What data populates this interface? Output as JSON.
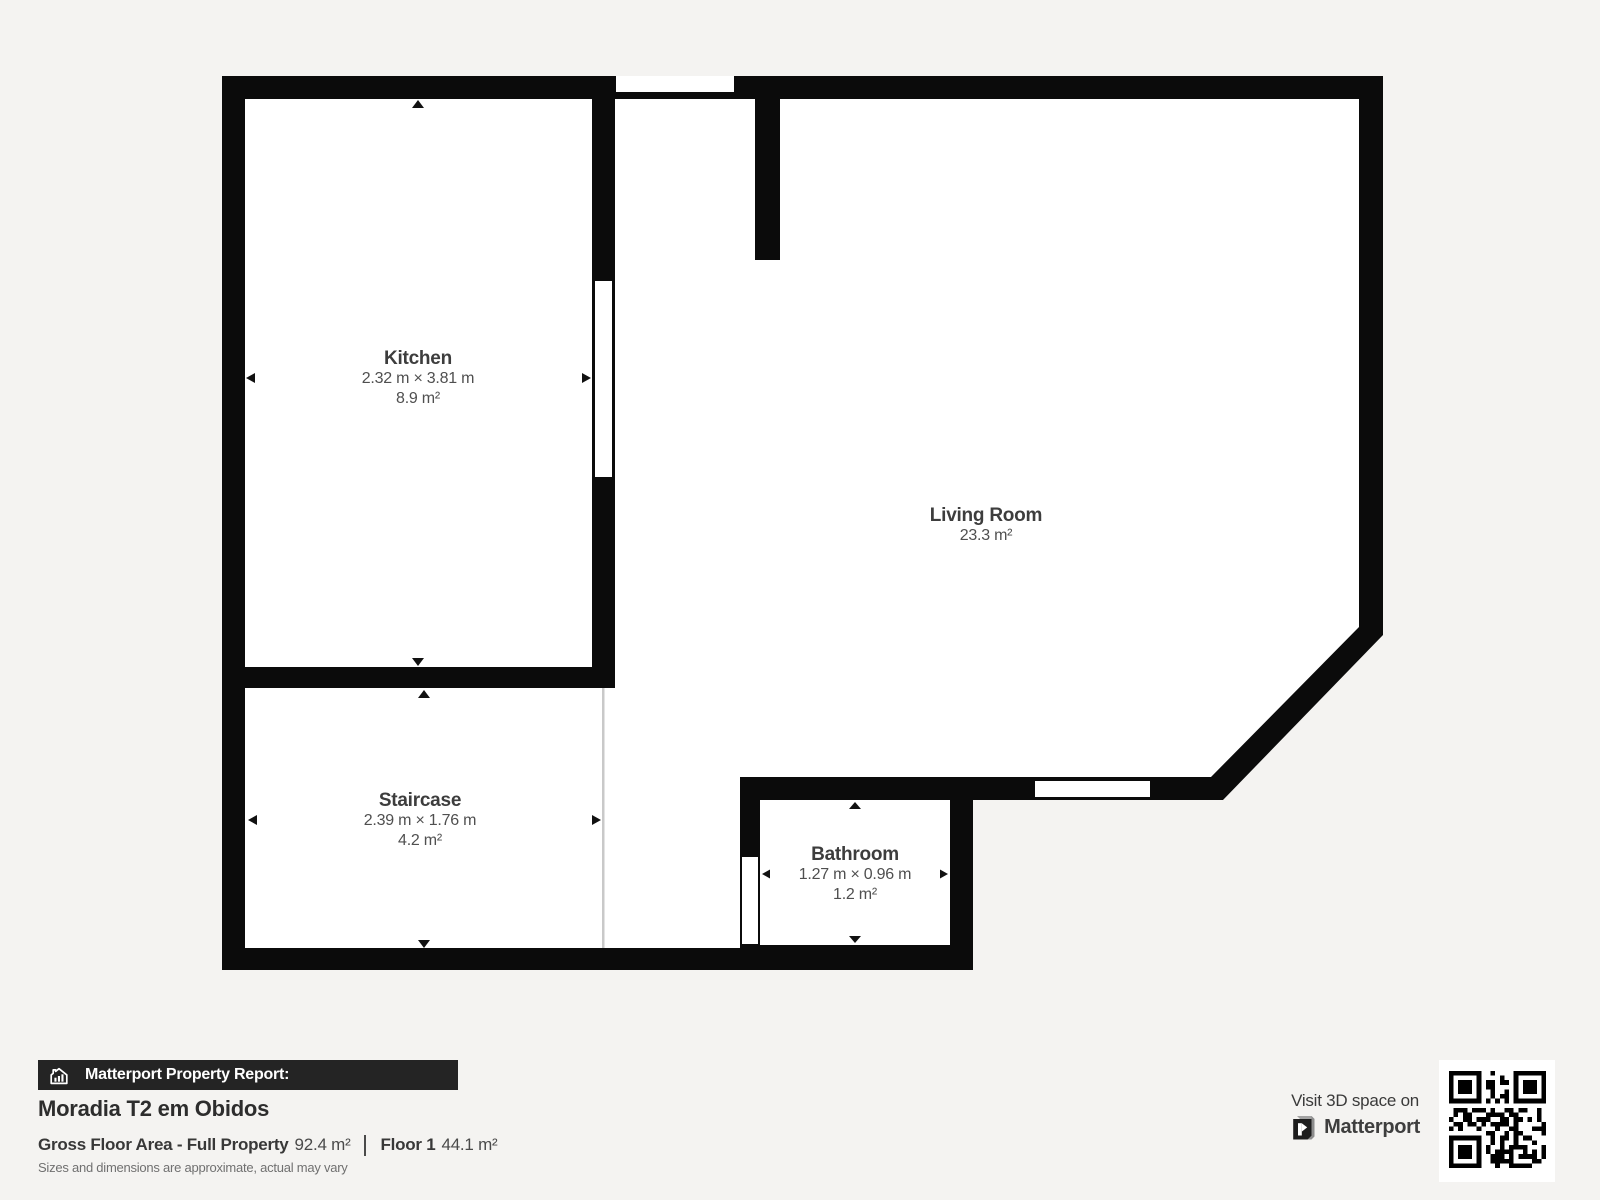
{
  "page": {
    "background": "#f4f3f1"
  },
  "floorplan": {
    "wall_color": "#0b0b0b",
    "floor_color": "#ffffff",
    "rooms": [
      {
        "name": "Kitchen",
        "dims": "2.32 m × 3.81 m",
        "area": "8.9 m²"
      },
      {
        "name": "Living Room",
        "area": "23.3 m²"
      },
      {
        "name": "Staircase",
        "dims": "2.39 m × 1.76 m",
        "area": "4.2 m²"
      },
      {
        "name": "Bathroom",
        "dims": "1.27 m × 0.96 m",
        "area": "1.2 m²"
      }
    ]
  },
  "footer": {
    "report_label": "Matterport Property Report:",
    "property_name": "Moradia T2 em Obidos",
    "gross_floor_area_label": "Gross Floor Area - Full Property",
    "gross_floor_area_value": "92.4 m²",
    "floor_label": "Floor 1",
    "floor_value": "44.1 m²",
    "disclaimer": "Sizes and dimensions are approximate, actual may vary",
    "visit_label": "Visit 3D space on",
    "brand_name": "Matterport"
  },
  "icons": {
    "report_icon": "house-chart-icon",
    "brand_icon": "matterport-m-icon",
    "qr": "qr-code"
  }
}
